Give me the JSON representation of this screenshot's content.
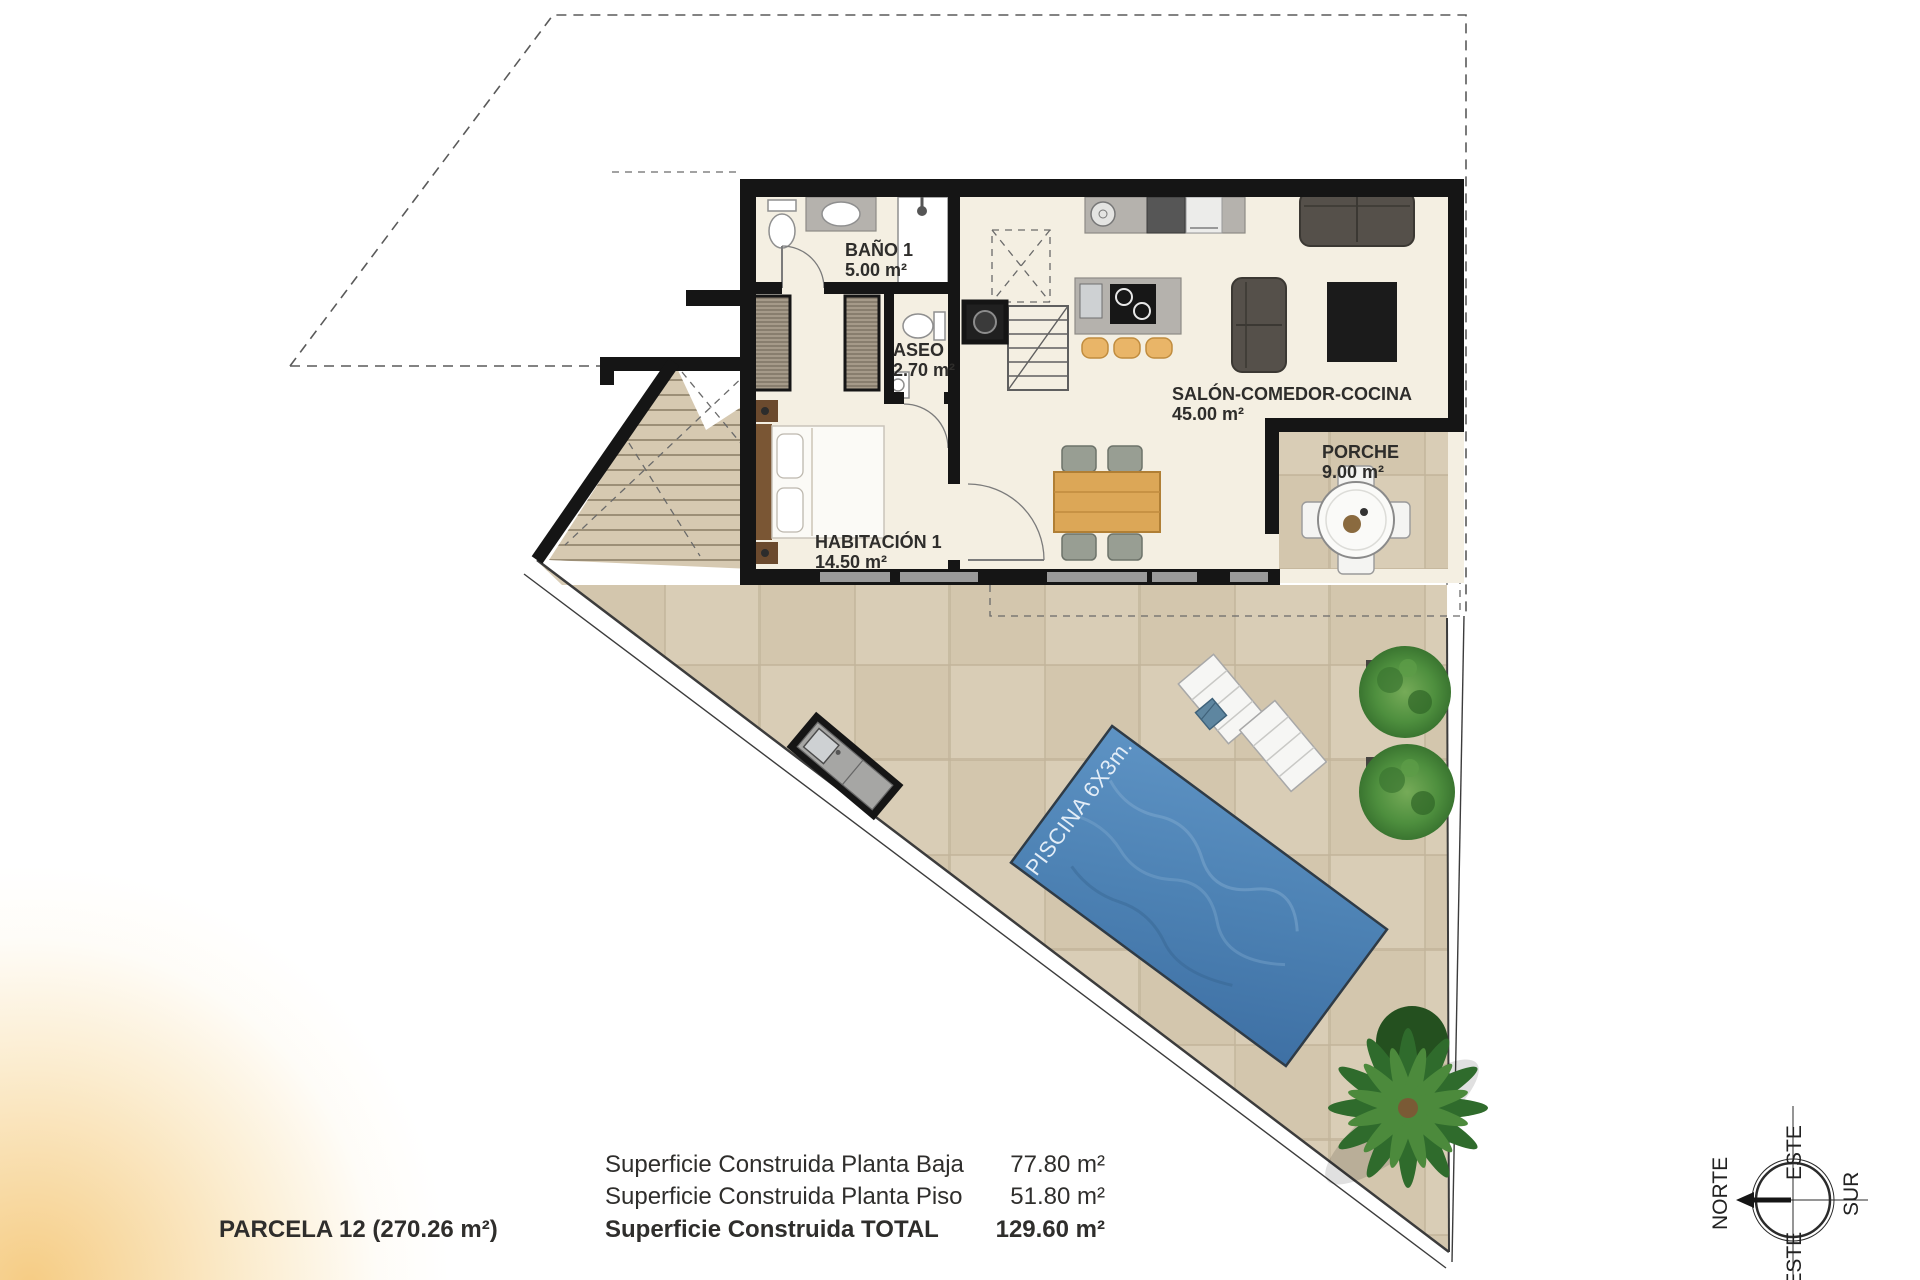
{
  "colors": {
    "wall": "#151515",
    "floor": "#f4efe2",
    "terrace": "#d9cdb6",
    "terrace_grid": "#c2b49a",
    "pool": "#4d82b4",
    "pool_deep": "#3e70a4",
    "tree": "#4e8f3e",
    "wood": "#dca757",
    "corner_glow": "#f4c36e"
  },
  "rooms": {
    "banyo1": {
      "name": "BAÑO 1",
      "area": "5.00 m²"
    },
    "aseo": {
      "name": "ASEO",
      "area": "2.70 m²"
    },
    "habitacion1": {
      "name": "HABITACIÓN 1",
      "area": "14.50 m²"
    },
    "salon": {
      "name": "SALÓN-COMEDOR-COCINA",
      "area": "45.00 m²"
    },
    "porche": {
      "name": "PORCHE",
      "area": "9.00 m²"
    }
  },
  "pool": {
    "label": "PISCINA 6X3m."
  },
  "compass": {
    "north": "NORTE",
    "east": "ESTE",
    "south": "SUR",
    "west": "OESTE"
  },
  "summary": {
    "parcel": "PARCELA 12 (270.26 m²)",
    "rows": [
      {
        "label": "Superficie Construida Planta Baja",
        "value": "77.80 m²"
      },
      {
        "label": "Superficie Construida Planta Piso",
        "value": "51.80 m²"
      },
      {
        "label": "Superficie Construida TOTAL",
        "value": "129.60 m²"
      }
    ]
  }
}
